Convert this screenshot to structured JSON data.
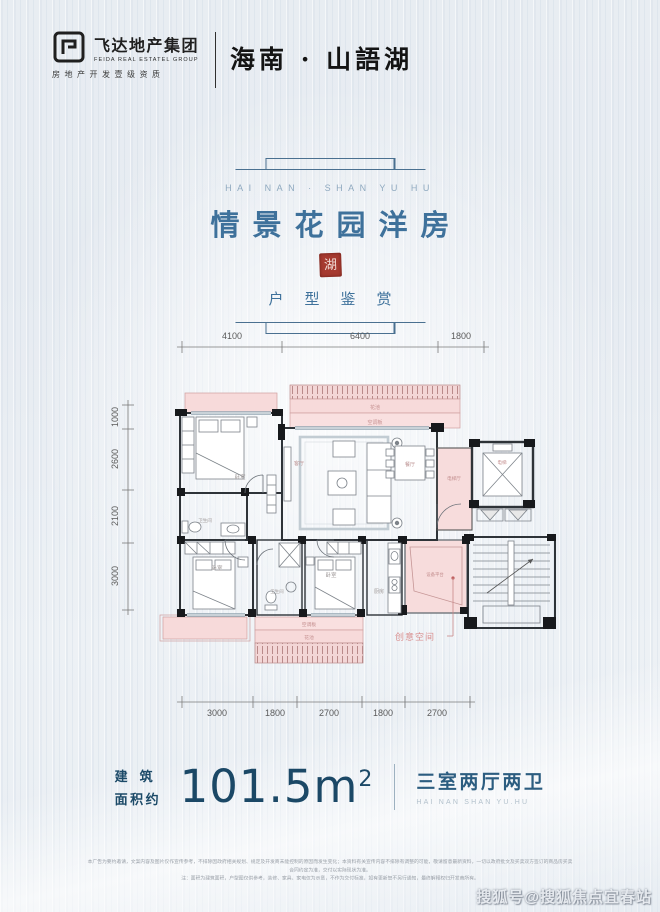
{
  "header": {
    "logo_cn": "飞达地产集团",
    "logo_en": "FEIDA REAL ESTATEL GROUP",
    "logo_cert": "房地产开发壹级资质",
    "brand": "海南 · 山語湖"
  },
  "title": {
    "en_caption": "HAI NAN · SHAN YU HU",
    "main": "情景花园洋房",
    "seal_char": "湖",
    "sub": "户型鉴赏"
  },
  "plan": {
    "dims_top": [
      "4100",
      "6400",
      "1800"
    ],
    "dims_left": [
      "1000",
      "2600",
      "2100",
      "3000"
    ],
    "dims_bottom": [
      "3000",
      "1800",
      "2700",
      "1800",
      "2700"
    ],
    "rooms": {
      "bedroom": "卧室",
      "living": "客厅",
      "dining": "餐厅",
      "bath": "卫生间",
      "kitchen": "厨房",
      "elevator": "电梯",
      "elevator_hall": "电梯厅",
      "flower_bed": "花池",
      "ac_panel": "空调板",
      "equip_platform": "设备平台"
    },
    "annotation_creative": "创意空间"
  },
  "spec": {
    "area_label_line1": "建筑",
    "area_label_line2": "面积约",
    "area_value": "101.5m",
    "area_sup": "2",
    "layout": "三室两厅两卫",
    "layout_en": "HAI NAN      SHAN YU.HU"
  },
  "disclaimer": {
    "line1": "本广告为要约邀请，文案内容及图片仅作宣传参考，不排除因政府相关规划、规定及开发商未能控制的原因而发生变化；本资料有关宣传内容不排除有调整的可能，敬请留意最新资料，一切以政府批文及买卖双方签订的商品房买卖合同约定为准，交付以实际现状为准。",
    "line2": "注：面积为建筑面积，户型图仅供参考，装修、家具、家电仅为示意，不作为交付标准，如有更新恕不另行通知，最终解释权归开发商所有。"
  },
  "watermark": "搜狐号@搜狐焦点宜春站",
  "colors": {
    "title_blue": "#3e719b",
    "dark_blue": "#1c4a68",
    "seal_red": "#a63a30",
    "pink_fill": "#f7dada",
    "pink_border": "#cf9f9f",
    "wall": "#2e3338",
    "background": "#e9edf2"
  }
}
